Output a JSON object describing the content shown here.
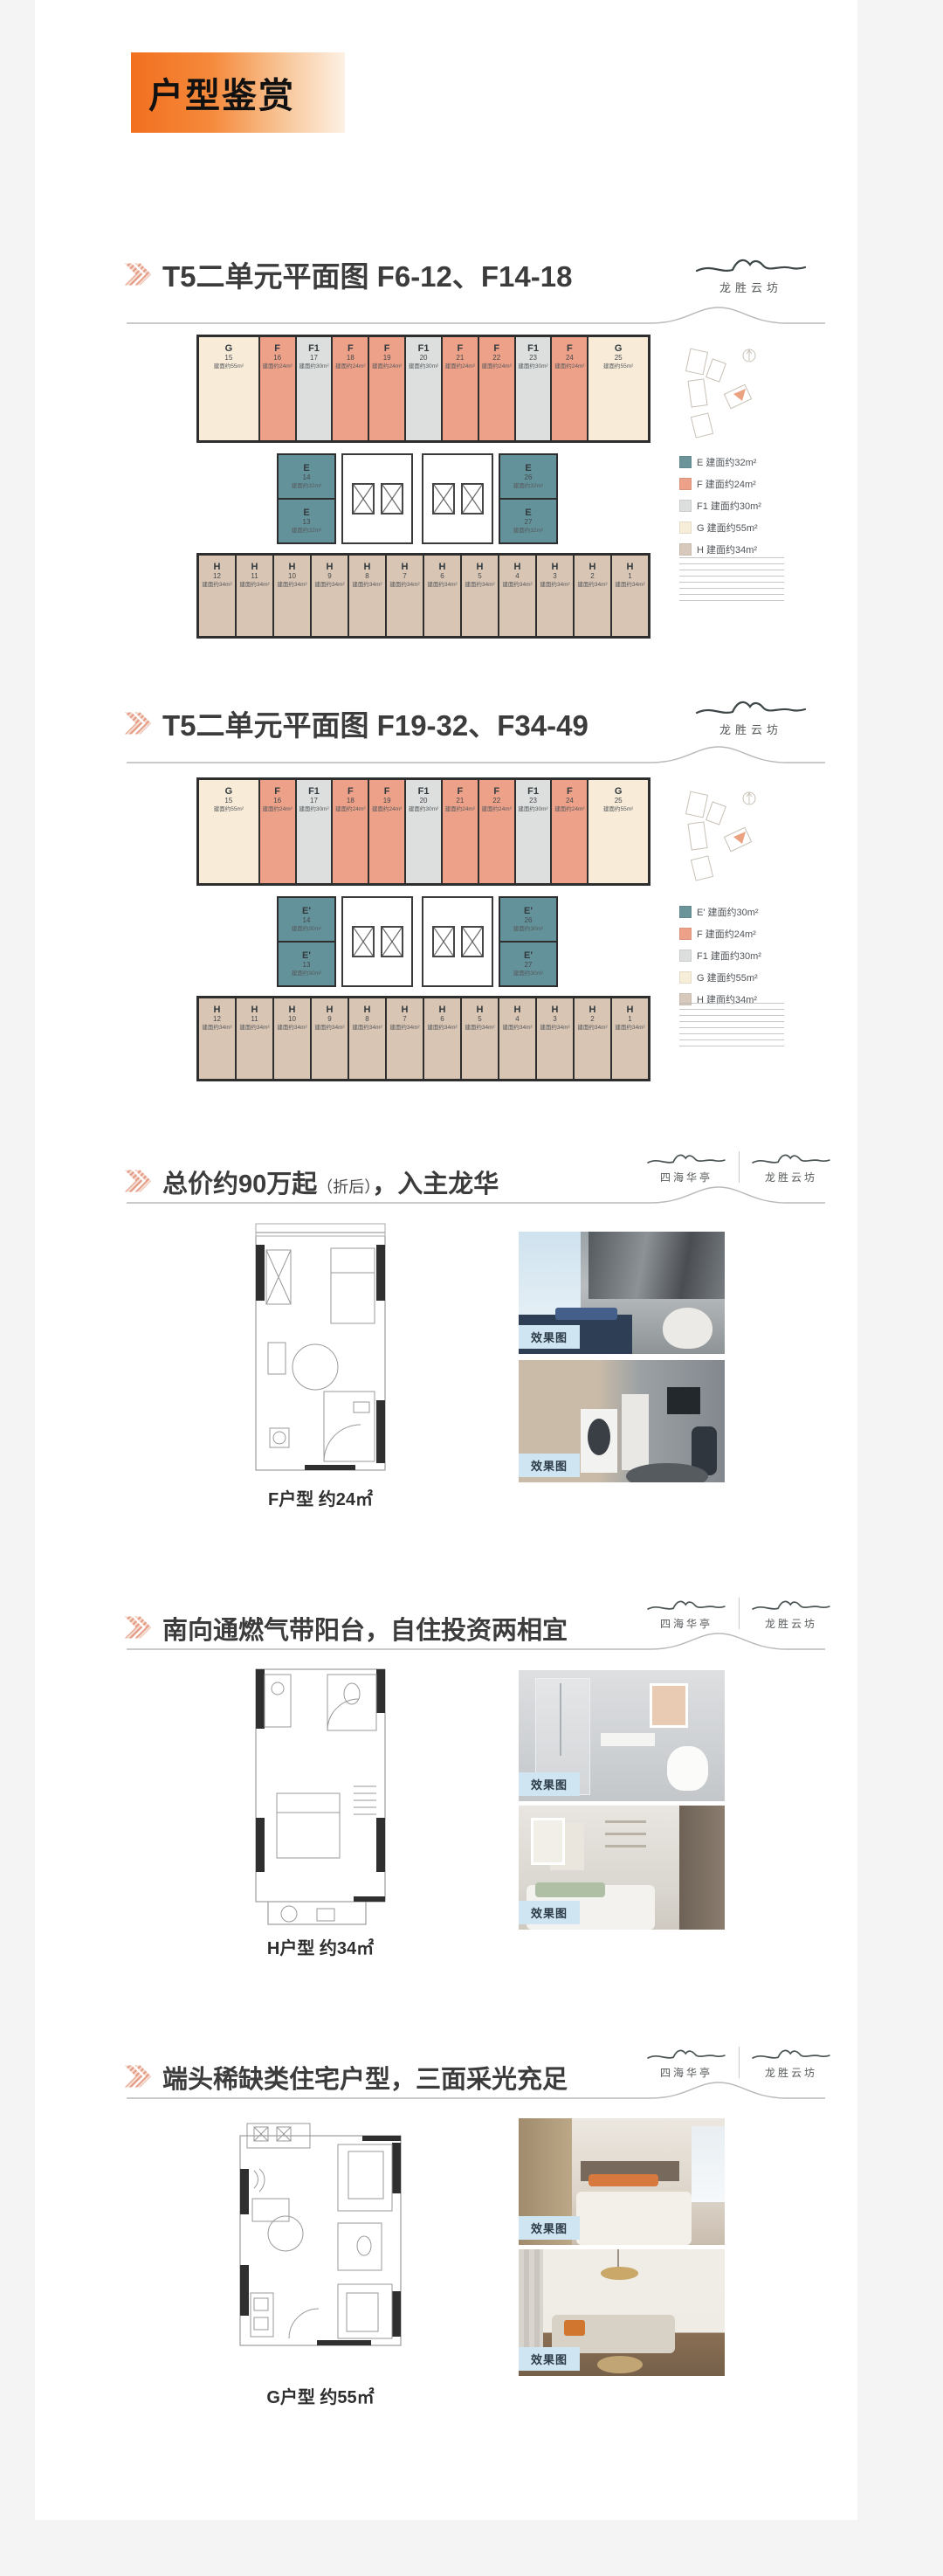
{
  "header": {
    "title": "户型鉴赏"
  },
  "logos": {
    "left": "四海华亭",
    "right": "龙胜云坊"
  },
  "misc": {
    "photo_label": "效果图"
  },
  "colors": {
    "accent_orange": "#f26f1f",
    "salmon": "#eda189",
    "teal": "#64929a",
    "unit_gray": "#dcdfde",
    "cream": "#f8ecd9",
    "tan": "#d9c5b4",
    "chip_blue": "#cfe5f2"
  },
  "sections": {
    "s3": {
      "t1": "总价约90万起",
      "note": "（折后）",
      "t2": "，入主龙华",
      "caption": "F户型 约24㎡"
    },
    "s4": {
      "title": "南向通燃气带阳台，自住投资两相宜",
      "caption": "H户型 约34㎡"
    },
    "s5": {
      "title": "端头稀缺类住宅户型，三面采光充足",
      "caption": "G户型 约55㎡"
    }
  },
  "plans": {
    "plan1": {
      "title": "T5二单元平面图 F6-12、F14-18",
      "top_units": [
        {
          "t": "G",
          "n": "15",
          "a": "建面约55m²",
          "c": "#f8ecd9",
          "flex": "1.7"
        },
        {
          "t": "F",
          "n": "16",
          "a": "建面约24m²",
          "c": "#eda189",
          "flex": "1"
        },
        {
          "t": "F1",
          "n": "17",
          "a": "建面约30m²",
          "c": "#dcdfde",
          "flex": "1"
        },
        {
          "t": "F",
          "n": "18",
          "a": "建面约24m²",
          "c": "#eda189",
          "flex": "1"
        },
        {
          "t": "F",
          "n": "19",
          "a": "建面约24m²",
          "c": "#eda189",
          "flex": "1"
        },
        {
          "t": "F1",
          "n": "20",
          "a": "建面约30m²",
          "c": "#dcdfde",
          "flex": "1"
        },
        {
          "t": "F",
          "n": "21",
          "a": "建面约24m²",
          "c": "#eda189",
          "flex": "1"
        },
        {
          "t": "F",
          "n": "22",
          "a": "建面约24m²",
          "c": "#eda189",
          "flex": "1"
        },
        {
          "t": "F1",
          "n": "23",
          "a": "建面约30m²",
          "c": "#dcdfde",
          "flex": "1"
        },
        {
          "t": "F",
          "n": "24",
          "a": "建面约24m²",
          "c": "#eda189",
          "flex": "1"
        },
        {
          "t": "G",
          "n": "25",
          "a": "建面约55m²",
          "c": "#f8ecd9",
          "flex": "1.7"
        }
      ],
      "e_left": [
        {
          "t": "E",
          "n": "14",
          "a": "建面约32m²",
          "c": "#64929a"
        },
        {
          "t": "E",
          "n": "13",
          "a": "建面约32m²",
          "c": "#64929a"
        }
      ],
      "e_right": [
        {
          "t": "E",
          "n": "26",
          "a": "建面约32m²",
          "c": "#64929a"
        },
        {
          "t": "E",
          "n": "27",
          "a": "建面约32m²",
          "c": "#64929a"
        }
      ],
      "h_units": [
        {
          "t": "H",
          "n": "12",
          "a": "建面约34m²",
          "c": "#d9c5b4"
        },
        {
          "t": "H",
          "n": "11",
          "a": "建面约34m²",
          "c": "#d9c5b4"
        },
        {
          "t": "H",
          "n": "10",
          "a": "建面约34m²",
          "c": "#d9c5b4"
        },
        {
          "t": "H",
          "n": "9",
          "a": "建面约34m²",
          "c": "#d9c5b4"
        },
        {
          "t": "H",
          "n": "8",
          "a": "建面约34m²",
          "c": "#d9c5b4"
        },
        {
          "t": "H",
          "n": "7",
          "a": "建面约34m²",
          "c": "#d9c5b4"
        },
        {
          "t": "H",
          "n": "6",
          "a": "建面约34m²",
          "c": "#d9c5b4"
        },
        {
          "t": "H",
          "n": "5",
          "a": "建面约34m²",
          "c": "#d9c5b4"
        },
        {
          "t": "H",
          "n": "4",
          "a": "建面约34m²",
          "c": "#d9c5b4"
        },
        {
          "t": "H",
          "n": "3",
          "a": "建面约34m²",
          "c": "#d9c5b4"
        },
        {
          "t": "H",
          "n": "2",
          "a": "建面约34m²",
          "c": "#d9c5b4"
        },
        {
          "t": "H",
          "n": "1",
          "a": "建面约34m²",
          "c": "#d9c5b4"
        }
      ],
      "legend": [
        {
          "label": "E 建面约32m²",
          "c": "#6b949a"
        },
        {
          "label": "F 建面约24m²",
          "c": "#eda189"
        },
        {
          "label": "F1 建面约30m²",
          "c": "#dcdfde"
        },
        {
          "label": "G 建面约55m²",
          "c": "#f7eeda"
        },
        {
          "label": "H 建面约34m²",
          "c": "#d7cabc"
        }
      ]
    },
    "plan2": {
      "title": "T5二单元平面图 F19-32、F34-49",
      "top_units": [
        {
          "t": "G",
          "n": "15",
          "a": "建面约55m²",
          "c": "#f8ecd9",
          "flex": "1.7"
        },
        {
          "t": "F",
          "n": "16",
          "a": "建面约24m²",
          "c": "#eda189",
          "flex": "1"
        },
        {
          "t": "F1",
          "n": "17",
          "a": "建面约30m²",
          "c": "#dcdfde",
          "flex": "1"
        },
        {
          "t": "F",
          "n": "18",
          "a": "建面约24m²",
          "c": "#eda189",
          "flex": "1"
        },
        {
          "t": "F",
          "n": "19",
          "a": "建面约24m²",
          "c": "#eda189",
          "flex": "1"
        },
        {
          "t": "F1",
          "n": "20",
          "a": "建面约30m²",
          "c": "#dcdfde",
          "flex": "1"
        },
        {
          "t": "F",
          "n": "21",
          "a": "建面约24m²",
          "c": "#eda189",
          "flex": "1"
        },
        {
          "t": "F",
          "n": "22",
          "a": "建面约24m²",
          "c": "#eda189",
          "flex": "1"
        },
        {
          "t": "F1",
          "n": "23",
          "a": "建面约30m²",
          "c": "#dcdfde",
          "flex": "1"
        },
        {
          "t": "F",
          "n": "24",
          "a": "建面约24m²",
          "c": "#eda189",
          "flex": "1"
        },
        {
          "t": "G",
          "n": "25",
          "a": "建面约55m²",
          "c": "#f8ecd9",
          "flex": "1.7"
        }
      ],
      "e_left": [
        {
          "t": "E'",
          "n": "14",
          "a": "建面约30m²",
          "c": "#64929a"
        },
        {
          "t": "E'",
          "n": "13",
          "a": "建面约30m²",
          "c": "#64929a"
        }
      ],
      "e_right": [
        {
          "t": "E'",
          "n": "26",
          "a": "建面约30m²",
          "c": "#64929a"
        },
        {
          "t": "E'",
          "n": "27",
          "a": "建面约30m²",
          "c": "#64929a"
        }
      ],
      "h_units": [
        {
          "t": "H",
          "n": "12",
          "a": "建面约34m²",
          "c": "#d9c5b4"
        },
        {
          "t": "H",
          "n": "11",
          "a": "建面约34m²",
          "c": "#d9c5b4"
        },
        {
          "t": "H",
          "n": "10",
          "a": "建面约34m²",
          "c": "#d9c5b4"
        },
        {
          "t": "H",
          "n": "9",
          "a": "建面约34m²",
          "c": "#d9c5b4"
        },
        {
          "t": "H",
          "n": "8",
          "a": "建面约34m²",
          "c": "#d9c5b4"
        },
        {
          "t": "H",
          "n": "7",
          "a": "建面约34m²",
          "c": "#d9c5b4"
        },
        {
          "t": "H",
          "n": "6",
          "a": "建面约34m²",
          "c": "#d9c5b4"
        },
        {
          "t": "H",
          "n": "5",
          "a": "建面约34m²",
          "c": "#d9c5b4"
        },
        {
          "t": "H",
          "n": "4",
          "a": "建面约34m²",
          "c": "#d9c5b4"
        },
        {
          "t": "H",
          "n": "3",
          "a": "建面约34m²",
          "c": "#d9c5b4"
        },
        {
          "t": "H",
          "n": "2",
          "a": "建面约34m²",
          "c": "#d9c5b4"
        },
        {
          "t": "H",
          "n": "1",
          "a": "建面约34m²",
          "c": "#d9c5b4"
        }
      ],
      "legend": [
        {
          "label": "E' 建面约30m²",
          "c": "#6b949a"
        },
        {
          "label": "F 建面约24m²",
          "c": "#eda189"
        },
        {
          "label": "F1 建面约30m²",
          "c": "#dcdfde"
        },
        {
          "label": "G 建面约55m²",
          "c": "#f7eeda"
        },
        {
          "label": "H 建面约34m²",
          "c": "#d7cabc"
        }
      ]
    }
  }
}
